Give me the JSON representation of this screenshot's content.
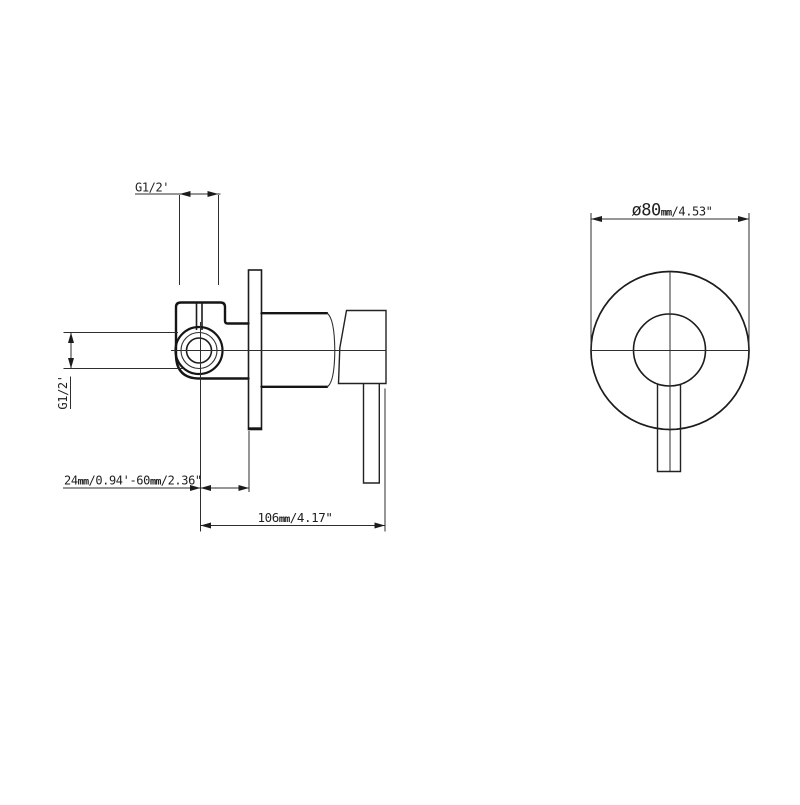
{
  "colors": {
    "background": "#ffffff",
    "outline": "#151515",
    "dimension_lines": "#2e2e2e",
    "text": "#1f1f1f"
  },
  "side_view": {
    "dim_top_thread": {
      "text": "G1/2'"
    },
    "dim_left_thread": {
      "text": "G1/2'"
    },
    "dim_depth_range": {
      "n1": "24",
      "u1": "mm",
      "r1": "/0.94'",
      "dash": "-",
      "n2": "60",
      "u2": "mm",
      "r2": "/2.36\""
    },
    "dim_total_depth": {
      "n": "106",
      "u": "mm",
      "r": "/4.17\""
    }
  },
  "front_view": {
    "dim_plate_diameter": {
      "n": "ø80",
      "u": "mm",
      "r": "/4.53\""
    }
  }
}
